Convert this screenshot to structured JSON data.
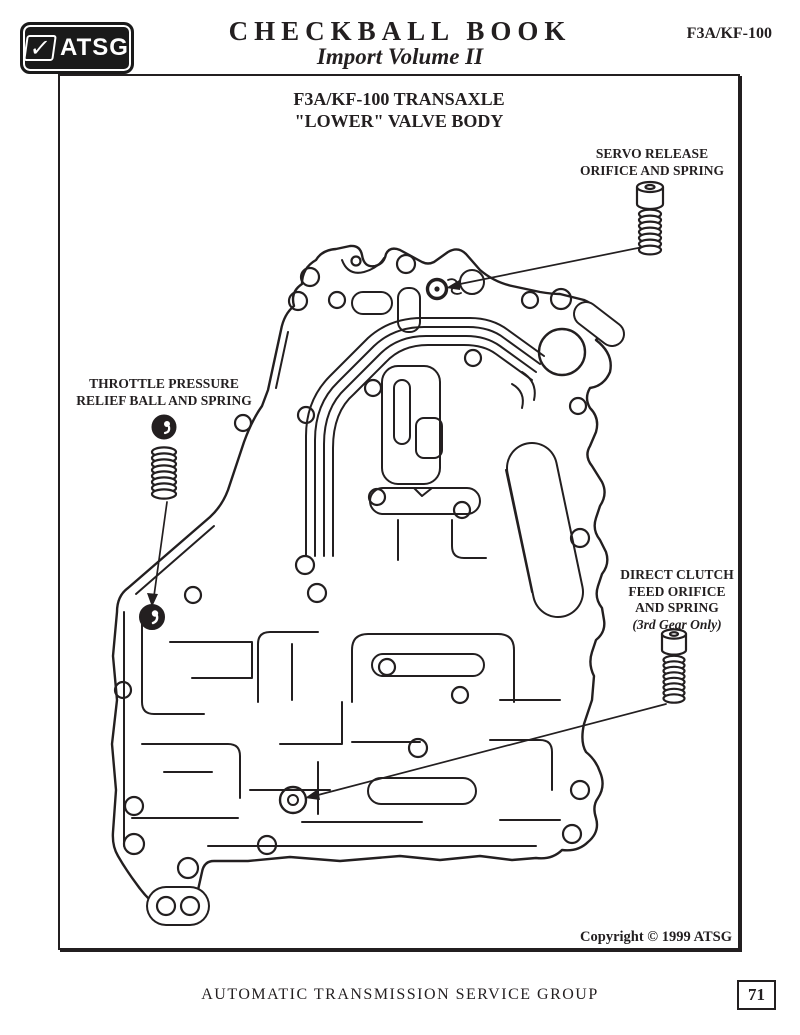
{
  "colors": {
    "ink": "#231f20",
    "paper": "#ffffff"
  },
  "icons": {
    "logo_check": "✓"
  },
  "header": {
    "logo_text": "ATSG",
    "title": "CHECKBALL BOOK",
    "subtitle": "Import Volume II",
    "doc_code": "F3A/KF-100"
  },
  "diagram": {
    "title_line1": "F3A/KF-100 TRANSAXLE",
    "title_line2": "\"LOWER\"  VALVE BODY",
    "callouts": {
      "servo": {
        "lines": [
          "SERVO RELEASE",
          "ORIFICE AND SPRING"
        ]
      },
      "throttle": {
        "lines": [
          "THROTTLE PRESSURE",
          "RELIEF BALL AND SPRING"
        ]
      },
      "direct": {
        "lines": [
          "DIRECT CLUTCH",
          "FEED ORIFICE",
          "AND SPRING"
        ],
        "note": "(3rd Gear Only)"
      }
    },
    "copyright": "Copyright © 1999  ATSG"
  },
  "footer": {
    "org": "AUTOMATIC TRANSMISSION SERVICE GROUP",
    "page_number": "71"
  }
}
